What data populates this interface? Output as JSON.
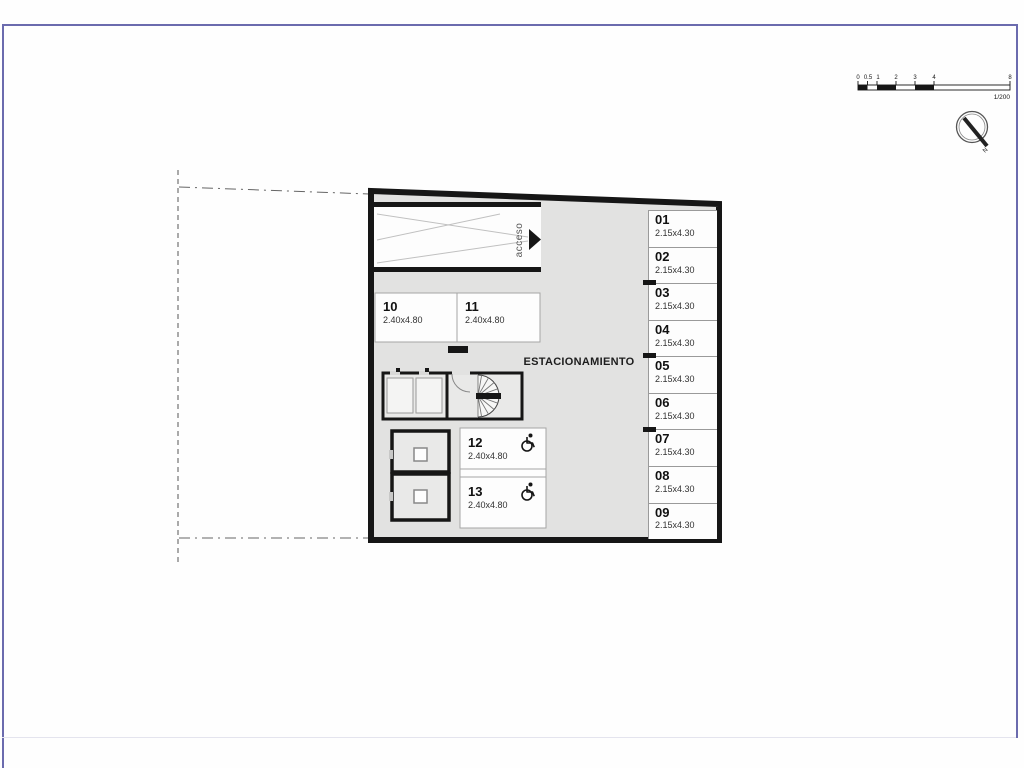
{
  "colors": {
    "frame_accent": "#6b6bae",
    "wall": "#161616",
    "interior_fill": "#e2e2e1",
    "stall_border": "#9a9a9a"
  },
  "scale_bar": {
    "tick_labels": [
      "0",
      "0.5",
      "1",
      "2",
      "3",
      "4",
      "8"
    ],
    "scale_text": "1/200"
  },
  "north_indicator": {
    "label": "N"
  },
  "floor_plan": {
    "area_label": "ESTACIONAMIENTO",
    "ramp": {
      "label": "acceso"
    },
    "perimeter_stalls": [
      {
        "num": "01",
        "dims": "2.15x4.30"
      },
      {
        "num": "02",
        "dims": "2.15x4.30"
      },
      {
        "num": "03",
        "dims": "2.15x4.30"
      },
      {
        "num": "04",
        "dims": "2.15x4.30"
      },
      {
        "num": "05",
        "dims": "2.15x4.30"
      },
      {
        "num": "06",
        "dims": "2.15x4.30"
      },
      {
        "num": "07",
        "dims": "2.15x4.30"
      },
      {
        "num": "08",
        "dims": "2.15x4.30"
      },
      {
        "num": "09",
        "dims": "2.15x4.30"
      }
    ],
    "interior_stalls": [
      {
        "num": "10",
        "dims": "2.40x4.80"
      },
      {
        "num": "11",
        "dims": "2.40x4.80"
      }
    ],
    "accessible_stalls": [
      {
        "num": "12",
        "dims": "2.40x4.80"
      },
      {
        "num": "13",
        "dims": "2.40x4.80"
      }
    ]
  }
}
